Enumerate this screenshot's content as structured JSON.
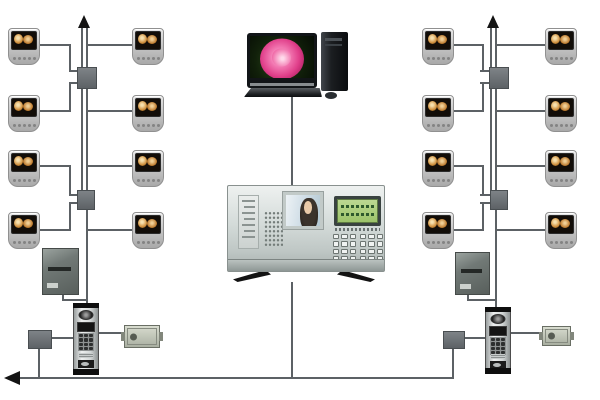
{
  "diagram": {
    "description": "Building video door-phone / intercom system wiring topology",
    "background_color": "#ffffff",
    "wire_color": "#5c6165",
    "device_counts": {
      "indoor_monitors": 16,
      "floor_distributors": 4,
      "riser_power_supplies": 2,
      "entrance_junction_boxes": 2,
      "outdoor_door_stations": 2,
      "electric_locks": 2,
      "management_computer": 1,
      "guard_management_unit": 1
    },
    "left_riser": {
      "monitor_rows": 4,
      "monitors_per_row": 2,
      "distributors": 2,
      "top_arrow": "up"
    },
    "right_riser": {
      "monitor_rows": 4,
      "monitors_per_row": 2,
      "distributors": 2,
      "top_arrow": "up"
    },
    "bottom_trunk": {
      "end_arrow": "left"
    },
    "computer": {
      "wallpaper": "pink rose on dark background",
      "parts": [
        "monitor",
        "tower",
        "keyboard",
        "mouse"
      ]
    },
    "guard_unit": {
      "video_screen": "caller portrait (woman)",
      "display": "green LCD with two text rows",
      "controls": [
        "label strip",
        "speaker grille",
        "24-key keypad"
      ],
      "stand": "two black feet"
    },
    "indoor_monitor": {
      "screen": "warm-toned video image",
      "buttons": 5
    }
  },
  "palette": {
    "monitor_body": "#c9cbca",
    "monitor_screen": "#120d08",
    "screen_image_warm": "#d1913f",
    "distributor_box": "#6b7174",
    "power_supply": "#6d7572",
    "door_station_body": "#d9dcdc",
    "door_station_caps": "#0e0e0e",
    "electric_lock": "#c0c6ba",
    "panel_body": "#d3dad8",
    "lcd_green": "#a5cc78",
    "photo_background": "#cfdde6",
    "rose_pink": "#e0548f",
    "tower_black": "#17191c",
    "arrow_black": "#141414"
  }
}
